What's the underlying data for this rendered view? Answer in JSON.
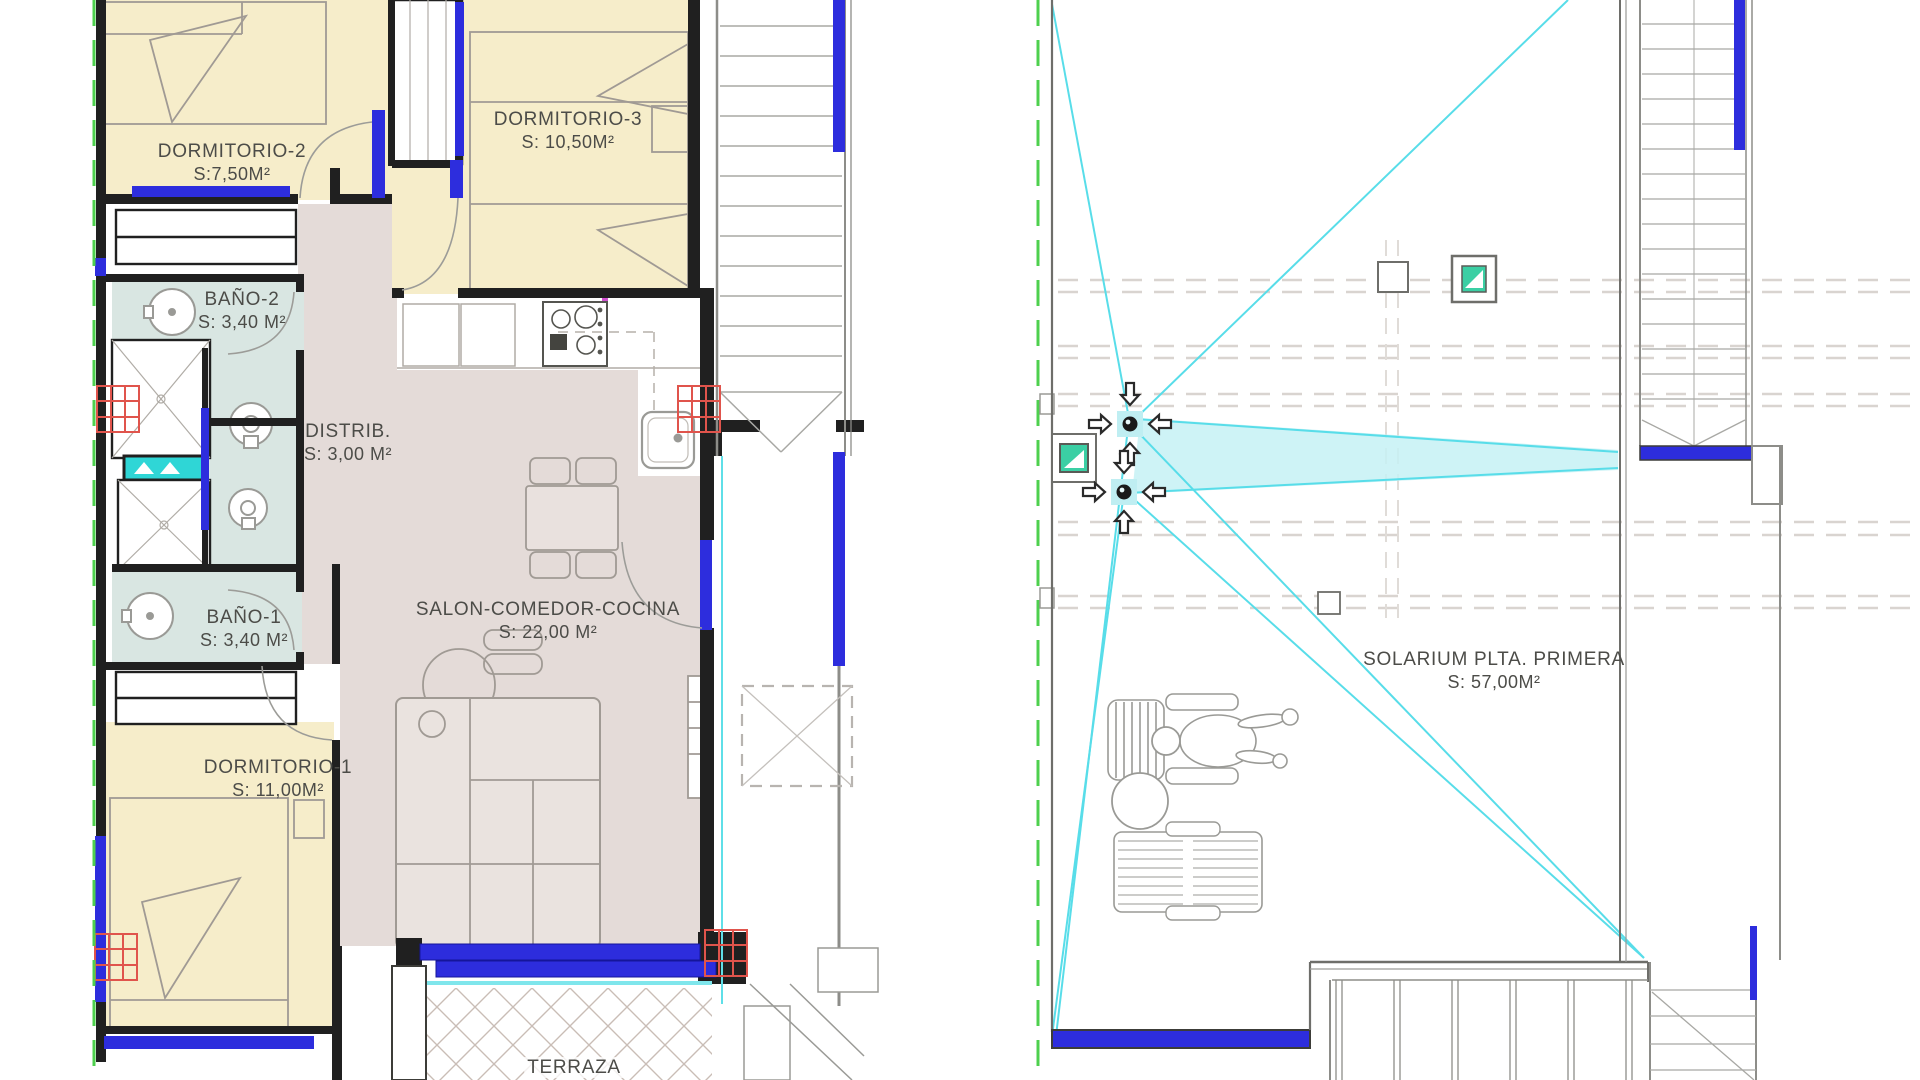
{
  "document": {
    "type": "architectural-floor-plan",
    "sheet": "planta primera + solarium"
  },
  "colors": {
    "wall": "#202020",
    "window_blue": "#2d2ddd",
    "bedroom_yellow": "#f6edca",
    "bath_teal": "#d9e6e2",
    "living_pink": "#e4dbd8",
    "slope_cyan": "#58dde9",
    "property_green": "#4ed04e",
    "column_red": "#e0544c",
    "furniture_gray": "#a09a94",
    "shelf_turquoise": "#2fd6d6",
    "skylight_teal": "#3bcfa4"
  },
  "symbols": {
    "drain": "inward-arrow-cross-marker",
    "skylight": "teal-square-with-white-triangle",
    "column": "red-hatched-grid",
    "roof_slope": "cyan-diagonal-lines",
    "property_line": "green-dashed-line"
  },
  "left_plan": {
    "rooms": [
      {
        "id": "dormitorio-2",
        "label": "DORMITORIO-2",
        "area": "S:7,50M²"
      },
      {
        "id": "dormitorio-3",
        "label": "DORMITORIO-3",
        "area": "S: 10,50M²"
      },
      {
        "id": "bano-2",
        "label": "BAÑO-2",
        "area": "S: 3,40 M²"
      },
      {
        "id": "distribuidor",
        "label": "DISTRIB.",
        "area": "S: 3,00 M²"
      },
      {
        "id": "bano-1",
        "label": "BAÑO-1",
        "area": "S: 3,40 M²"
      },
      {
        "id": "salon-comedor-cocina",
        "label": "SALON-COMEDOR-COCINA",
        "area": "S: 22,00 M²"
      },
      {
        "id": "dormitorio-1",
        "label": "DORMITORIO-1",
        "area": "S: 11,00M²"
      },
      {
        "id": "terraza",
        "label": "TERRAZA",
        "area": ""
      }
    ]
  },
  "right_plan": {
    "rooms": [
      {
        "id": "solarium",
        "label": "SOLARIUM PLTA. PRIMERA",
        "area": "S: 57,00M²"
      }
    ]
  }
}
